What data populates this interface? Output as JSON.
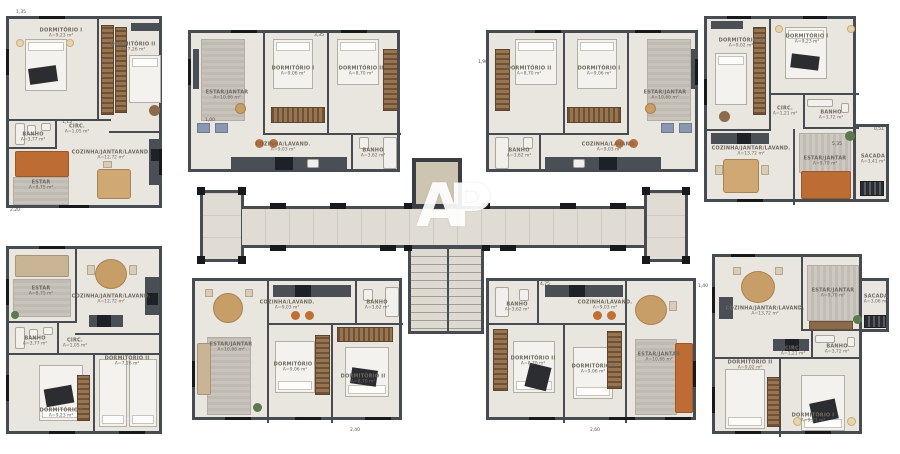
{
  "watermark": {
    "text": "AP"
  },
  "colors": {
    "floor": "#e9e6df",
    "wall": "#474c53",
    "corridor_floor": "#e0dcd4",
    "elevator_floor": "#cdc5b1",
    "sofa_orange": "#bd6c34",
    "wood": "#c89e68",
    "wardrobe": "#6e5138",
    "rug": "#c3bfb6"
  },
  "units": [
    {
      "name": "top-far-left",
      "rooms": [
        {
          "label": "DORMITÓRIO I",
          "area": "A=9,23 m²"
        },
        {
          "label": "DORMITÓRIO II",
          "area": "A=7,26 m²"
        },
        {
          "label": "BANHO",
          "area": "A=3,77 m²"
        },
        {
          "label": "CIRC.",
          "area": "A=1,05 m²"
        },
        {
          "label": "ESTAR",
          "area": "A=8,75 m²"
        },
        {
          "label": "COZINHA/JANTAR/LAVAND.",
          "area": "A=12,72 m²"
        }
      ]
    },
    {
      "name": "top-mid-left",
      "rooms": [
        {
          "label": "ESTAR/JANTAR",
          "area": "A=10,66 m²"
        },
        {
          "label": "DORMITÓRIO I",
          "area": "A=9,06 m²"
        },
        {
          "label": "DORMITÓRIO II",
          "area": "A=8,70 m²"
        },
        {
          "label": "COZINHA/LAVAND.",
          "area": "A=9,03 m²"
        },
        {
          "label": "BANHO",
          "area": "A=3,62 m²"
        }
      ]
    },
    {
      "name": "top-mid-right",
      "rooms": [
        {
          "label": "DORMITÓRIO II",
          "area": "A=8,70 m²"
        },
        {
          "label": "DORMITÓRIO I",
          "area": "A=9,06 m²"
        },
        {
          "label": "ESTAR/JANTAR",
          "area": "A=10,66 m²"
        },
        {
          "label": "COZINHA/LAVAND.",
          "area": "A=9,03 m²"
        },
        {
          "label": "BANHO",
          "area": "A=3,62 m²"
        }
      ]
    },
    {
      "name": "top-far-right",
      "rooms": [
        {
          "label": "DORMITÓRIO II",
          "area": "A=9,02 m²"
        },
        {
          "label": "DORMITÓRIO I",
          "area": "A=9,23 m²"
        },
        {
          "label": "BANHO",
          "area": "A=3,72 m²"
        },
        {
          "label": "CIRC.",
          "area": "A=1,21 m²"
        },
        {
          "label": "COZINHA/JANTAR/LAVAND.",
          "area": "A=13,72 m²"
        },
        {
          "label": "ESTAR/JANTAR",
          "area": "A=9,70 m²"
        },
        {
          "label": "SACADA",
          "area": "A=3,41 m²"
        }
      ]
    },
    {
      "name": "bottom-far-left",
      "rooms": [
        {
          "label": "ESTAR",
          "area": "A=8,75 m²"
        },
        {
          "label": "COZINHA/JANTAR/LAVAND.",
          "area": "A=12,72 m²"
        },
        {
          "label": "BANHO",
          "area": "A=3,77 m²"
        },
        {
          "label": "CIRC.",
          "area": "A=1,05 m²"
        },
        {
          "label": "DORMITÓRIO I",
          "area": "A=9,23 m²"
        },
        {
          "label": "DORMITÓRIO II",
          "area": "A=7,26 m²"
        }
      ]
    },
    {
      "name": "bottom-mid-left",
      "rooms": [
        {
          "label": "ESTAR/JANTAR",
          "area": "A=10,66 m²"
        },
        {
          "label": "COZINHA/LAVAND.",
          "area": "A=9,03 m²"
        },
        {
          "label": "BANHO",
          "area": "A=3,62 m²"
        },
        {
          "label": "DORMITÓRIO I",
          "area": "A=9,06 m²"
        },
        {
          "label": "DORMITÓRIO II",
          "area": "A=8,70 m²"
        }
      ]
    },
    {
      "name": "bottom-mid-right",
      "rooms": [
        {
          "label": "BANHO",
          "area": "A=3,62 m²"
        },
        {
          "label": "COZINHA/LAVAND.",
          "area": "A=9,03 m²"
        },
        {
          "label": "DORMITÓRIO II",
          "area": "A=8,70 m²"
        },
        {
          "label": "DORMITÓRIO I",
          "area": "A=9,06 m²"
        },
        {
          "label": "ESTAR/JANTAR",
          "area": "A=10,66 m²"
        }
      ]
    },
    {
      "name": "bottom-far-right",
      "rooms": [
        {
          "label": "COZINHA/JANTAR/LAVAND.",
          "area": "A=13,72 m²"
        },
        {
          "label": "ESTAR/JANTAR",
          "area": "A=9,70 m²"
        },
        {
          "label": "SACADA",
          "area": "A=3,06 m²"
        },
        {
          "label": "BANHO",
          "area": "A=3,72 m²"
        },
        {
          "label": "CIRC.",
          "area": "A=1,21 m²"
        },
        {
          "label": "DORMITÓRIO II",
          "area": "A=9,02 m²"
        },
        {
          "label": "DORMITÓRIO I",
          "area": "A=9,23 m²"
        }
      ]
    }
  ],
  "dims": [
    "1,35",
    "3,35",
    "5,35",
    "1,15",
    "4,75",
    "2,20",
    "1,00",
    "1,90",
    "2,40",
    "1,40",
    "0,51",
    "2,60"
  ]
}
